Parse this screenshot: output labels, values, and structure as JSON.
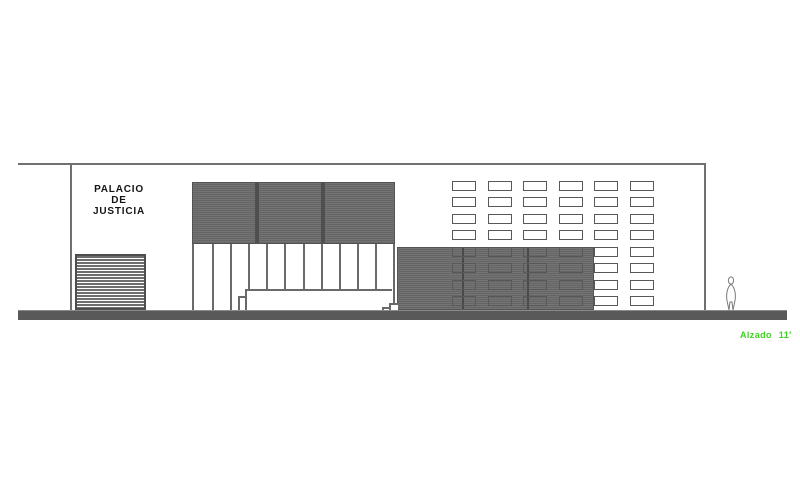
{
  "title": {
    "building_label": "PALACIO\nDE\nJUSTICIA"
  },
  "annotation": {
    "label": "Alzado 11′"
  },
  "colors": {
    "volume_grey": "#6e6e6e",
    "line_grey": "#6a6a6a",
    "ground_grey": "#595959",
    "annotation_green": "#3cd41c",
    "background": "#ffffff"
  },
  "drawing": {
    "panel_sections": 3,
    "colonnade_bays": 11,
    "block_sections": 3,
    "window_grid": {
      "rows": 8,
      "cols": 6
    }
  }
}
